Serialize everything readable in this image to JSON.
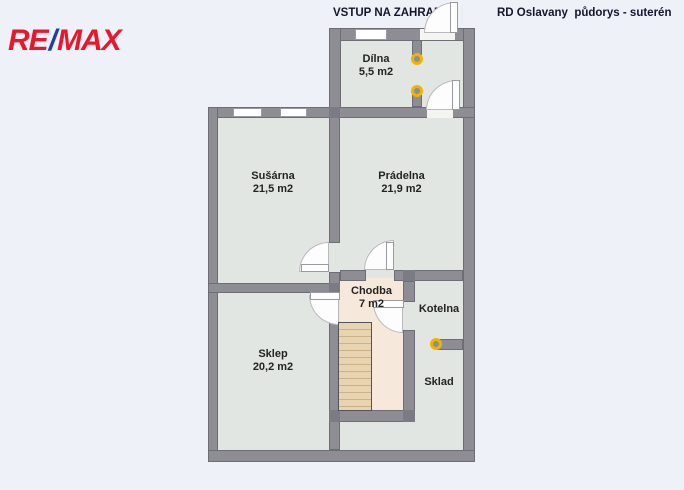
{
  "header": {
    "logo_re": "RE",
    "logo_slash": "/",
    "logo_max": "MAX",
    "top_label": "VSTUP NA ZAHRADU",
    "title": "RD Oslavany  půdorys - suterén"
  },
  "rooms": [
    {
      "id": "dilna",
      "name": "Dílna",
      "area": "5,5 m2"
    },
    {
      "id": "susarna",
      "name": "Sušárna",
      "area": "21,5 m2"
    },
    {
      "id": "pradelna",
      "name": "Prádelna",
      "area": "21,9 m2"
    },
    {
      "id": "chodba",
      "name": "Chodba",
      "area": "7 m2"
    },
    {
      "id": "kotelna",
      "name": "Kotelna"
    },
    {
      "id": "sklep",
      "name": "Sklep",
      "area": "20,2 m2"
    },
    {
      "id": "sklad",
      "name": "Sklad"
    }
  ],
  "colors": {
    "background": "#eef1f7",
    "wall": "#8d8d93",
    "room_fill": "#e2e6e2",
    "hall_fill": "#f6e8da",
    "stairs_fill": "#e8d4b0",
    "marker_yellow": "#f0b400",
    "remax_red": "#e8172c",
    "remax_blue": "#1f419e"
  },
  "markers": [
    {
      "type": "yellow-ring",
      "location": "dilna-doorway-top"
    },
    {
      "type": "yellow-ring",
      "location": "dilna-doorway-bottom"
    },
    {
      "type": "yellow-ring",
      "location": "kotelna-sklad-wall-end"
    }
  ]
}
